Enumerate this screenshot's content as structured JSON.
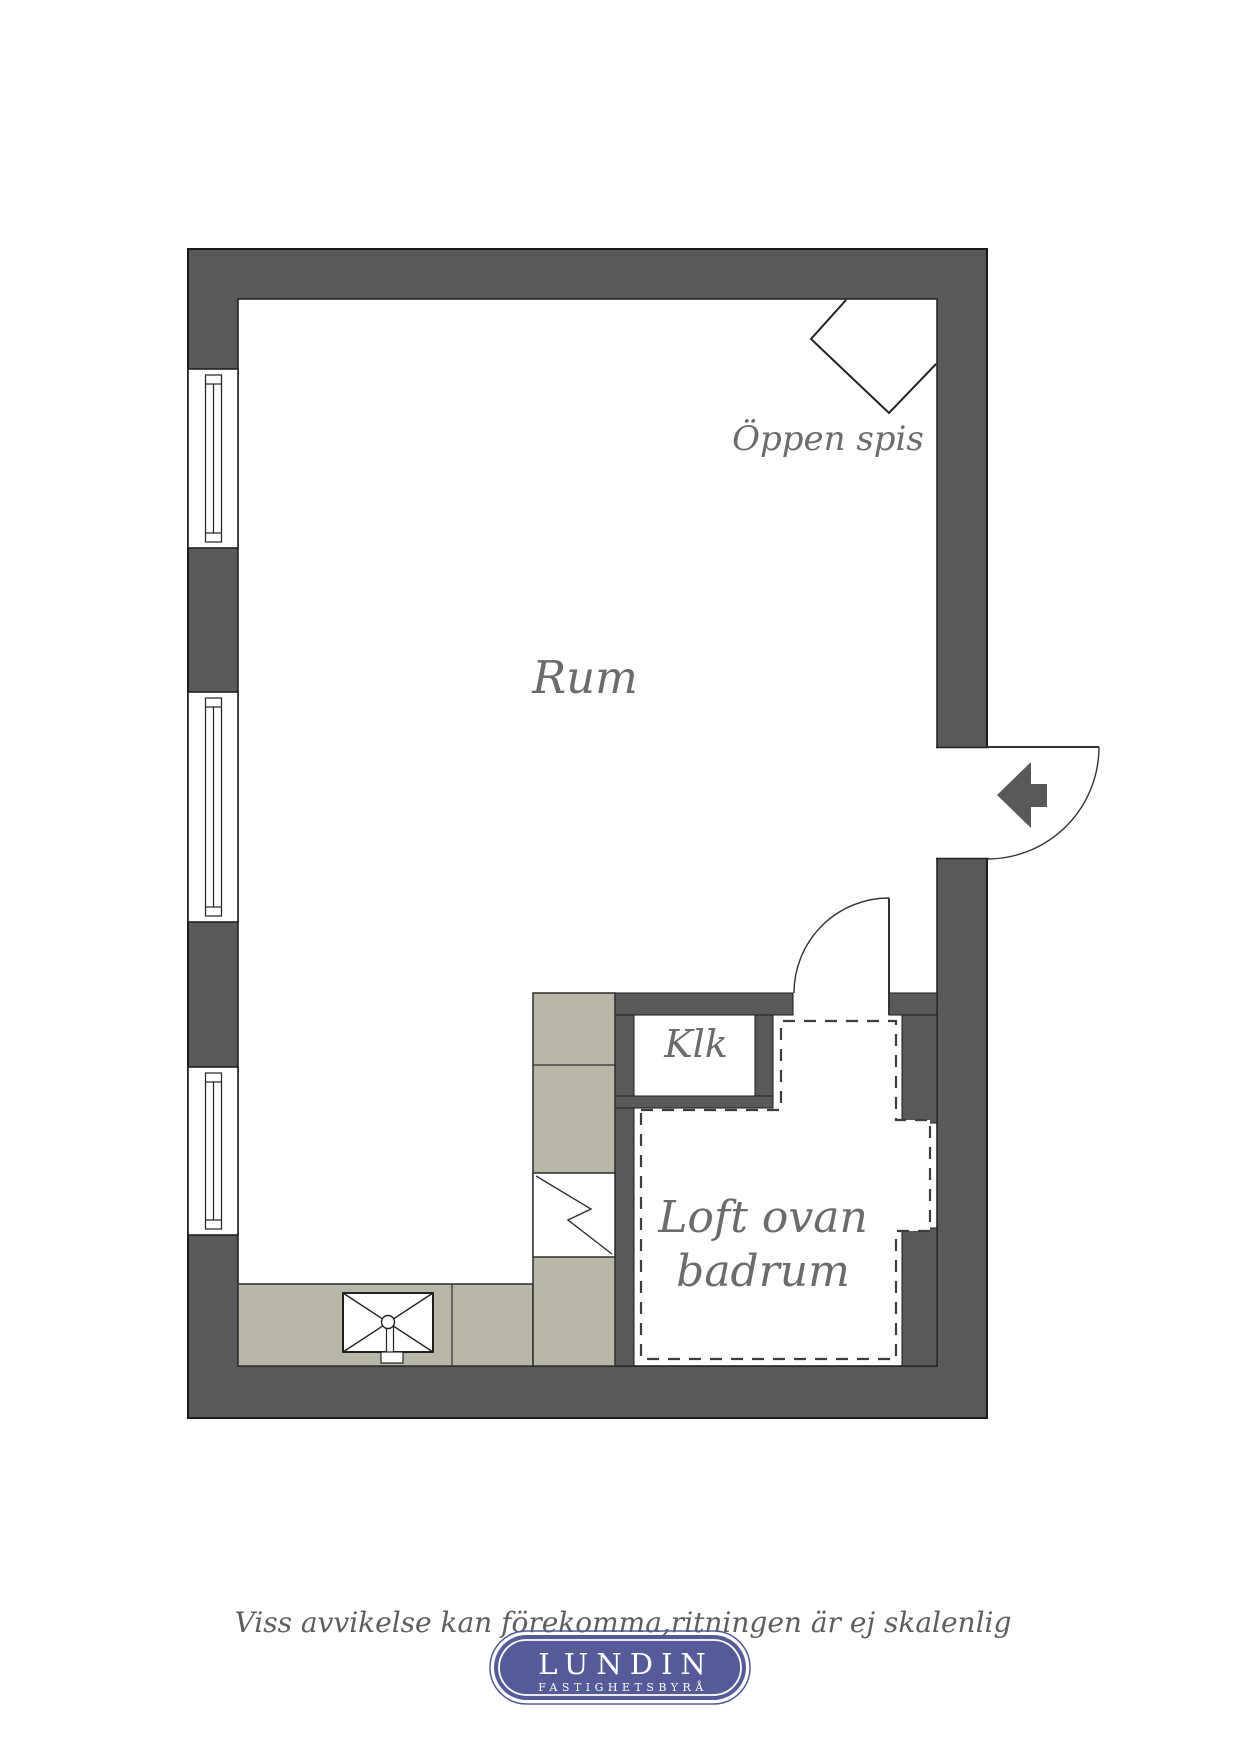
{
  "floorplan": {
    "title_note": "studio floor plan",
    "colors": {
      "wall": "#59595b",
      "floor": "#ffffff",
      "cabinet": "#b9b7a8",
      "outline": "#262626",
      "dashed_line": "#3c3c3c",
      "label_text": "#6b6b6b",
      "logo_blue": "#555a99",
      "logo_text": "#ffffff"
    },
    "labels": {
      "rum": "Rum",
      "oppen_spis": "Öppen spis",
      "klk": "Klk",
      "loft_line1": "Loft ovan",
      "loft_line2": "badrum"
    }
  },
  "footer": {
    "disclaimer": "Viss avvikelse kan förekomma,ritningen är ej skalenlig",
    "logo_name": "LUNDIN",
    "logo_subtitle": "FASTIGHETSBYRÅ"
  }
}
